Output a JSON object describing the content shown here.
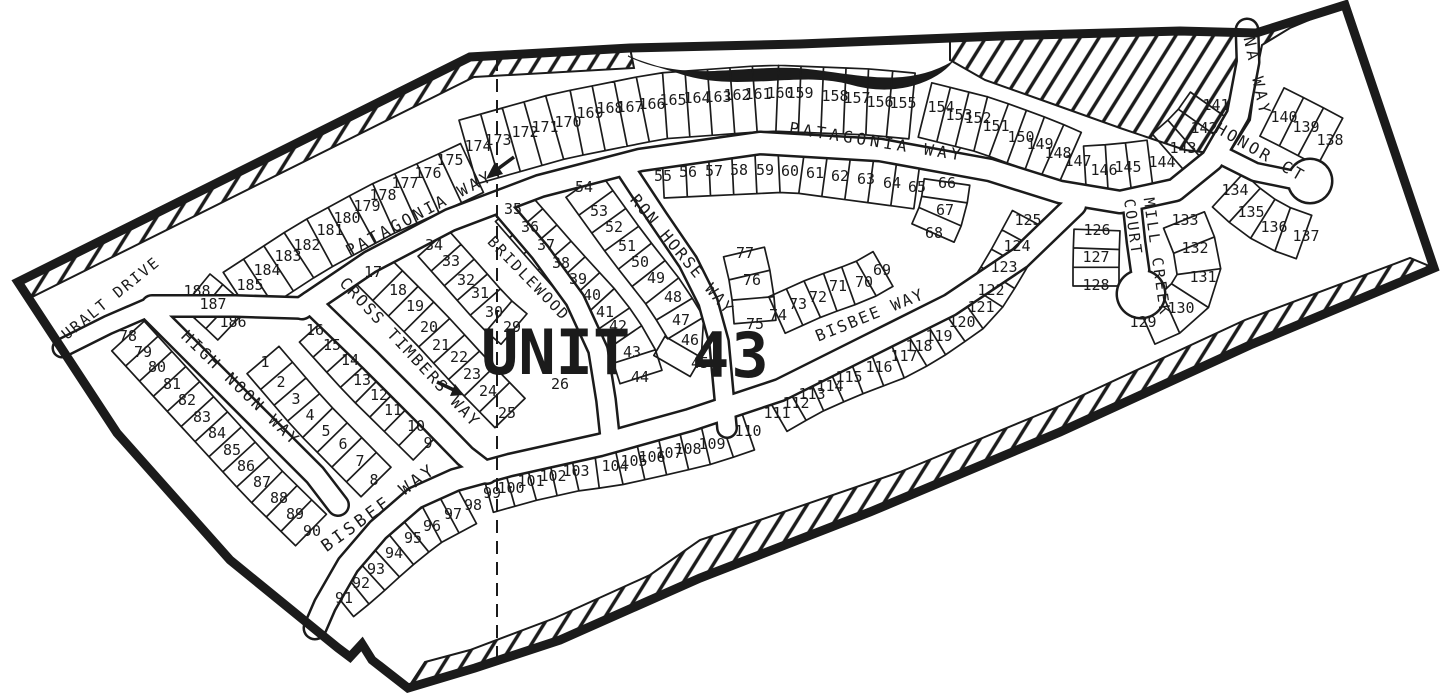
{
  "map": {
    "unit_label": "UNIT",
    "unit_number": "43",
    "ink_color": "#1b1b1b",
    "paper_color": "#ffffff",
    "streets": [
      {
        "name": "URALT DRIVE",
        "x": 114,
        "y": 302,
        "rot": -39,
        "size": 15,
        "ls": 2
      },
      {
        "name": "HIGH NOON WAY",
        "x": 237,
        "y": 392,
        "rot": 44,
        "size": 16,
        "ls": 2.5
      },
      {
        "name": "CROSS TIMBERS WAY",
        "x": 406,
        "y": 356,
        "rot": 47,
        "size": 16,
        "ls": 2
      },
      {
        "name": "PATAGONIA WAY",
        "x": 422,
        "y": 218,
        "rot": -28,
        "size": 16,
        "ls": 3
      },
      {
        "name": "PATAGONIA WAY",
        "x": 876,
        "y": 147,
        "rot": 9,
        "size": 16,
        "ls": 4
      },
      {
        "name": "NA WAY",
        "x": 1252,
        "y": 78,
        "rot": 78,
        "size": 16,
        "ls": 4
      },
      {
        "name": "HONOR CT",
        "x": 1258,
        "y": 157,
        "rot": 30,
        "size": 16,
        "ls": 3
      },
      {
        "name": "RON HORSE WAY",
        "x": 678,
        "y": 258,
        "rot": 50,
        "size": 16,
        "ls": 2
      },
      {
        "name": "BRIDLEWOOD",
        "x": 525,
        "y": 282,
        "rot": 46,
        "size": 15,
        "ls": 2
      },
      {
        "name": "BISBEE WAY",
        "x": 872,
        "y": 320,
        "rot": -22,
        "size": 16,
        "ls": 2
      },
      {
        "name": "BISBEE WAY",
        "x": 382,
        "y": 512,
        "rot": -36,
        "size": 17,
        "ls": 3.5
      },
      {
        "name": "MILL CREEK",
        "x": 1152,
        "y": 258,
        "rot": 82,
        "size": 15,
        "ls": 3
      },
      {
        "name": "COURT",
        "x": 1128,
        "y": 228,
        "rot": 82,
        "size": 15,
        "ls": 2.5
      }
    ],
    "lots": [
      [
        "1",
        265,
        362
      ],
      [
        "2",
        281,
        382
      ],
      [
        "3",
        296,
        399
      ],
      [
        "4",
        310,
        415
      ],
      [
        "5",
        326,
        431
      ],
      [
        "6",
        343,
        444
      ],
      [
        "7",
        360,
        461
      ],
      [
        "8",
        374,
        480
      ],
      [
        "9",
        428,
        443
      ],
      [
        "10",
        416,
        426
      ],
      [
        "11",
        393,
        410
      ],
      [
        "12",
        379,
        395
      ],
      [
        "13",
        362,
        380
      ],
      [
        "14",
        350,
        360
      ],
      [
        "15",
        332,
        345
      ],
      [
        "16",
        315,
        330
      ],
      [
        "17",
        373,
        272
      ],
      [
        "18",
        398,
        290
      ],
      [
        "19",
        415,
        306
      ],
      [
        "20",
        429,
        327
      ],
      [
        "21",
        441,
        345
      ],
      [
        "22",
        459,
        357
      ],
      [
        "23",
        472,
        374
      ],
      [
        "24",
        488,
        391
      ],
      [
        "25",
        507,
        413
      ],
      [
        "26",
        560,
        384
      ],
      [
        "29",
        512,
        327
      ],
      [
        "30",
        494,
        312
      ],
      [
        "31",
        480,
        293
      ],
      [
        "32",
        466,
        280
      ],
      [
        "33",
        451,
        261
      ],
      [
        "34",
        434,
        245
      ],
      [
        "35",
        513,
        209
      ],
      [
        "36",
        530,
        227
      ],
      [
        "37",
        546,
        245
      ],
      [
        "38",
        561,
        263
      ],
      [
        "39",
        578,
        279
      ],
      [
        "40",
        592,
        295
      ],
      [
        "41",
        605,
        312
      ],
      [
        "42",
        618,
        326
      ],
      [
        "43",
        632,
        352
      ],
      [
        "44",
        640,
        377
      ],
      [
        "45",
        700,
        363
      ],
      [
        "46",
        690,
        340
      ],
      [
        "47",
        681,
        320
      ],
      [
        "48",
        673,
        297
      ],
      [
        "49",
        656,
        278
      ],
      [
        "50",
        640,
        262
      ],
      [
        "51",
        627,
        246
      ],
      [
        "52",
        614,
        227
      ],
      [
        "53",
        599,
        211
      ],
      [
        "54",
        584,
        187
      ],
      [
        "55",
        663,
        176
      ],
      [
        "56",
        688,
        172
      ],
      [
        "57",
        714,
        171
      ],
      [
        "58",
        739,
        170
      ],
      [
        "59",
        765,
        170
      ],
      [
        "60",
        790,
        171
      ],
      [
        "61",
        815,
        173
      ],
      [
        "62",
        840,
        176
      ],
      [
        "63",
        866,
        179
      ],
      [
        "64",
        892,
        183
      ],
      [
        "65",
        917,
        187
      ],
      [
        "66",
        947,
        183
      ],
      [
        "67",
        945,
        210
      ],
      [
        "68",
        934,
        233
      ],
      [
        "69",
        882,
        270
      ],
      [
        "70",
        864,
        282
      ],
      [
        "71",
        838,
        286
      ],
      [
        "72",
        818,
        297
      ],
      [
        "73",
        798,
        304
      ],
      [
        "74",
        778,
        315
      ],
      [
        "75",
        755,
        324
      ],
      [
        "76",
        752,
        280
      ],
      [
        "77",
        745,
        253
      ],
      [
        "78",
        128,
        336
      ],
      [
        "79",
        143,
        352
      ],
      [
        "80",
        157,
        367
      ],
      [
        "81",
        172,
        384
      ],
      [
        "82",
        187,
        400
      ],
      [
        "83",
        202,
        417
      ],
      [
        "84",
        217,
        433
      ],
      [
        "85",
        232,
        450
      ],
      [
        "86",
        246,
        466
      ],
      [
        "87",
        262,
        482
      ],
      [
        "88",
        279,
        498
      ],
      [
        "89",
        295,
        514
      ],
      [
        "90",
        312,
        531
      ],
      [
        "91",
        344,
        598
      ],
      [
        "92",
        361,
        583
      ],
      [
        "93",
        376,
        569
      ],
      [
        "94",
        394,
        553
      ],
      [
        "95",
        413,
        538
      ],
      [
        "96",
        432,
        526
      ],
      [
        "97",
        453,
        514
      ],
      [
        "98",
        473,
        505
      ],
      [
        "99",
        492,
        493
      ],
      [
        "100",
        511,
        488
      ],
      [
        "101",
        531,
        481
      ],
      [
        "102",
        553,
        476
      ],
      [
        "103",
        576,
        471
      ],
      [
        "104",
        615,
        466
      ],
      [
        "105",
        634,
        461
      ],
      [
        "106",
        652,
        457
      ],
      [
        "107",
        669,
        453
      ],
      [
        "108",
        688,
        449
      ],
      [
        "109",
        712,
        444
      ],
      [
        "110",
        748,
        431
      ],
      [
        "111",
        777,
        413
      ],
      [
        "112",
        796,
        403
      ],
      [
        "113",
        812,
        394
      ],
      [
        "114",
        830,
        386
      ],
      [
        "115",
        849,
        377
      ],
      [
        "116",
        879,
        367
      ],
      [
        "117",
        904,
        356
      ],
      [
        "118",
        919,
        346
      ],
      [
        "119",
        939,
        336
      ],
      [
        "120",
        962,
        322
      ],
      [
        "121",
        981,
        307
      ],
      [
        "122",
        991,
        290
      ],
      [
        "123",
        1004,
        267
      ],
      [
        "124",
        1017,
        246
      ],
      [
        "125",
        1028,
        220
      ],
      [
        "126",
        1097,
        230
      ],
      [
        "127",
        1096,
        257
      ],
      [
        "128",
        1096,
        285
      ],
      [
        "129",
        1143,
        322
      ],
      [
        "130",
        1181,
        308
      ],
      [
        "131",
        1203,
        277
      ],
      [
        "132",
        1195,
        248
      ],
      [
        "133",
        1185,
        220
      ],
      [
        "134",
        1235,
        190
      ],
      [
        "135",
        1251,
        212
      ],
      [
        "136",
        1274,
        227
      ],
      [
        "137",
        1306,
        236
      ],
      [
        "138",
        1330,
        140
      ],
      [
        "139",
        1306,
        127
      ],
      [
        "140",
        1284,
        117
      ],
      [
        "141",
        1216,
        105
      ],
      [
        "142",
        1204,
        128
      ],
      [
        "143",
        1183,
        148
      ],
      [
        "144",
        1162,
        162
      ],
      [
        "145",
        1128,
        167
      ],
      [
        "146",
        1104,
        170
      ],
      [
        "147",
        1078,
        161
      ],
      [
        "148",
        1058,
        153
      ],
      [
        "149",
        1040,
        144
      ],
      [
        "150",
        1021,
        137
      ],
      [
        "151",
        996,
        126
      ],
      [
        "152",
        978,
        118
      ],
      [
        "153",
        959,
        115
      ],
      [
        "154",
        941,
        107
      ],
      [
        "155",
        903,
        103
      ],
      [
        "156",
        880,
        102
      ],
      [
        "157",
        857,
        98
      ],
      [
        "158",
        835,
        96
      ],
      [
        "159",
        800,
        93
      ],
      [
        "160",
        780,
        93
      ],
      [
        "161",
        758,
        94
      ],
      [
        "162",
        737,
        95
      ],
      [
        "163",
        718,
        97
      ],
      [
        "164",
        697,
        98
      ],
      [
        "165",
        673,
        100
      ],
      [
        "166",
        652,
        104
      ],
      [
        "167",
        630,
        107
      ],
      [
        "168",
        610,
        108
      ],
      [
        "169",
        590,
        113
      ],
      [
        "170",
        568,
        122
      ],
      [
        "171",
        545,
        127
      ],
      [
        "172",
        525,
        132
      ],
      [
        "173",
        498,
        140
      ],
      [
        "174",
        478,
        146
      ],
      [
        "175",
        450,
        160
      ],
      [
        "176",
        428,
        173
      ],
      [
        "177",
        405,
        183
      ],
      [
        "178",
        383,
        195
      ],
      [
        "179",
        367,
        206
      ],
      [
        "180",
        347,
        218
      ],
      [
        "181",
        330,
        230
      ],
      [
        "182",
        307,
        245
      ],
      [
        "183",
        288,
        256
      ],
      [
        "184",
        267,
        270
      ],
      [
        "185",
        250,
        285
      ],
      [
        "186",
        233,
        322
      ],
      [
        "187",
        213,
        304
      ],
      [
        "188",
        197,
        291
      ]
    ]
  }
}
